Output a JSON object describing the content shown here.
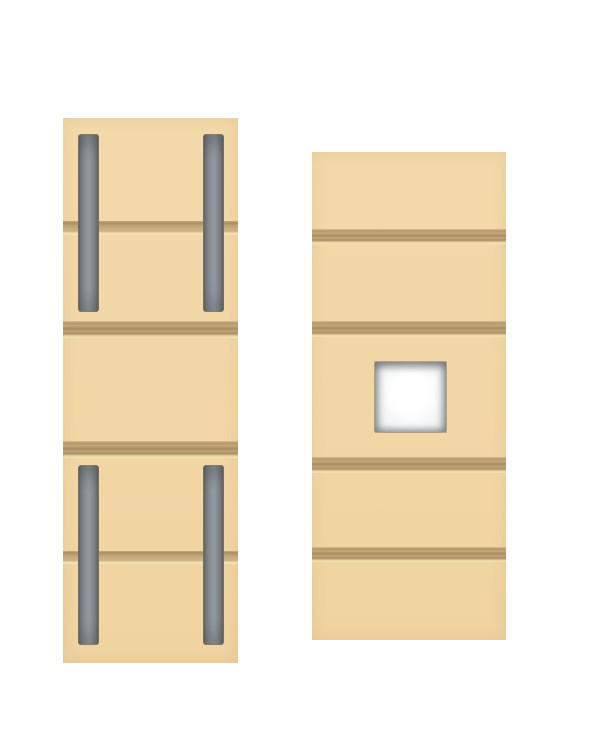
{
  "scene": {
    "background_color": "#ffffff",
    "panel_color": "#f2d7a6",
    "groove_dark_color": "#a98d60",
    "groove_mid_color": "#c8ad7e",
    "groove_highlight_color": "#f2deae",
    "slot_gray_color": "#9ba1a7",
    "slot_gray_dark_color": "#74797d",
    "hole_color": "#ffffff"
  },
  "panels": [
    {
      "name": "left-panel",
      "x": 63,
      "y": 118,
      "width": 175,
      "height": 545,
      "grooves": [
        {
          "name": "groove-1",
          "y": 221,
          "height": 14,
          "style": "single"
        },
        {
          "name": "groove-2",
          "y": 321,
          "height": 17,
          "style": "double"
        },
        {
          "name": "groove-3",
          "y": 441,
          "height": 17,
          "style": "double"
        },
        {
          "name": "groove-4",
          "y": 551,
          "height": 13,
          "style": "single"
        }
      ],
      "slots": [
        {
          "name": "slot-top-left",
          "x": 78,
          "y": 134,
          "width": 19,
          "height": 176
        },
        {
          "name": "slot-top-right",
          "x": 203,
          "y": 134,
          "width": 19,
          "height": 176
        },
        {
          "name": "slot-bottom-left",
          "x": 78,
          "y": 465,
          "width": 19,
          "height": 178
        },
        {
          "name": "slot-bottom-right",
          "x": 203,
          "y": 465,
          "width": 19,
          "height": 178
        }
      ],
      "holes": []
    },
    {
      "name": "right-panel",
      "x": 312,
      "y": 152,
      "width": 194,
      "height": 488,
      "grooves": [
        {
          "name": "groove-1",
          "y": 229,
          "height": 15,
          "style": "double"
        },
        {
          "name": "groove-2",
          "y": 321,
          "height": 16,
          "style": "double"
        },
        {
          "name": "groove-3",
          "y": 457,
          "height": 16,
          "style": "double"
        },
        {
          "name": "groove-4",
          "y": 547,
          "height": 15,
          "style": "double"
        }
      ],
      "slots": [],
      "holes": [
        {
          "name": "square-hole",
          "x": 374,
          "y": 361,
          "width": 71,
          "height": 70
        }
      ]
    }
  ]
}
